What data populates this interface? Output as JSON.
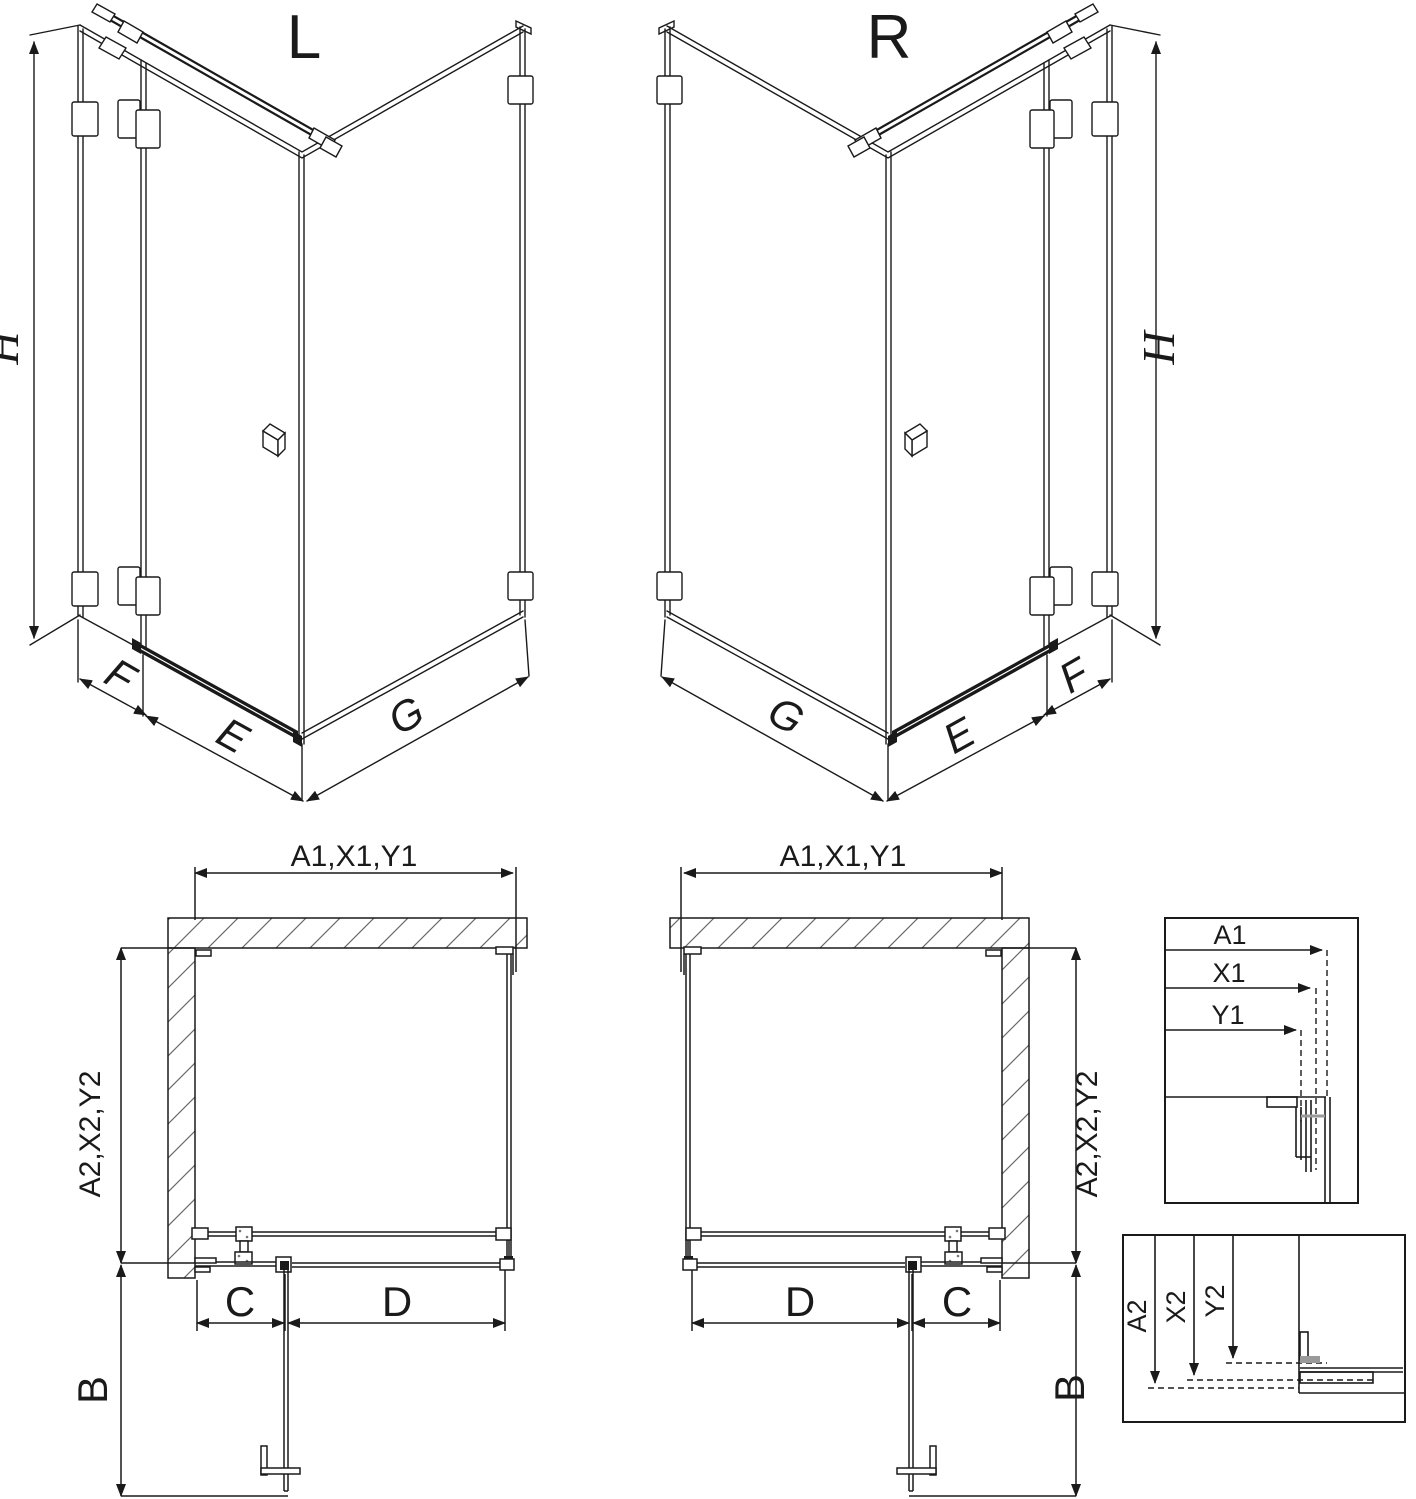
{
  "colors": {
    "line": "#1a1a1a",
    "hatch": "#6a6a6a",
    "gray_profile": "#9a9a9a",
    "background": "#ffffff"
  },
  "iso_views": [
    {
      "variant_label": "L",
      "height_label": "H",
      "fixed_panel_label": "F",
      "door_label": "E",
      "side_panel_label": "G"
    },
    {
      "variant_label": "R",
      "height_label": "H",
      "fixed_panel_label": "F",
      "door_label": "E",
      "side_panel_label": "G"
    }
  ],
  "plan_views": [
    {
      "width_label": "A1,X1,Y1",
      "depth_label": "A2,X2,Y2",
      "fixed_segment_label": "C",
      "door_segment_label": "D",
      "swing_label": "B"
    },
    {
      "width_label": "A1,X1,Y1",
      "depth_label": "A2,X2,Y2",
      "fixed_segment_label": "C",
      "door_segment_label": "D",
      "swing_label": "B"
    }
  ],
  "detail_views": {
    "width_detail": {
      "arrow_labels": [
        "A1",
        "X1",
        "Y1"
      ]
    },
    "depth_detail": {
      "arrow_labels": [
        "A2",
        "X2",
        "Y2"
      ]
    }
  }
}
